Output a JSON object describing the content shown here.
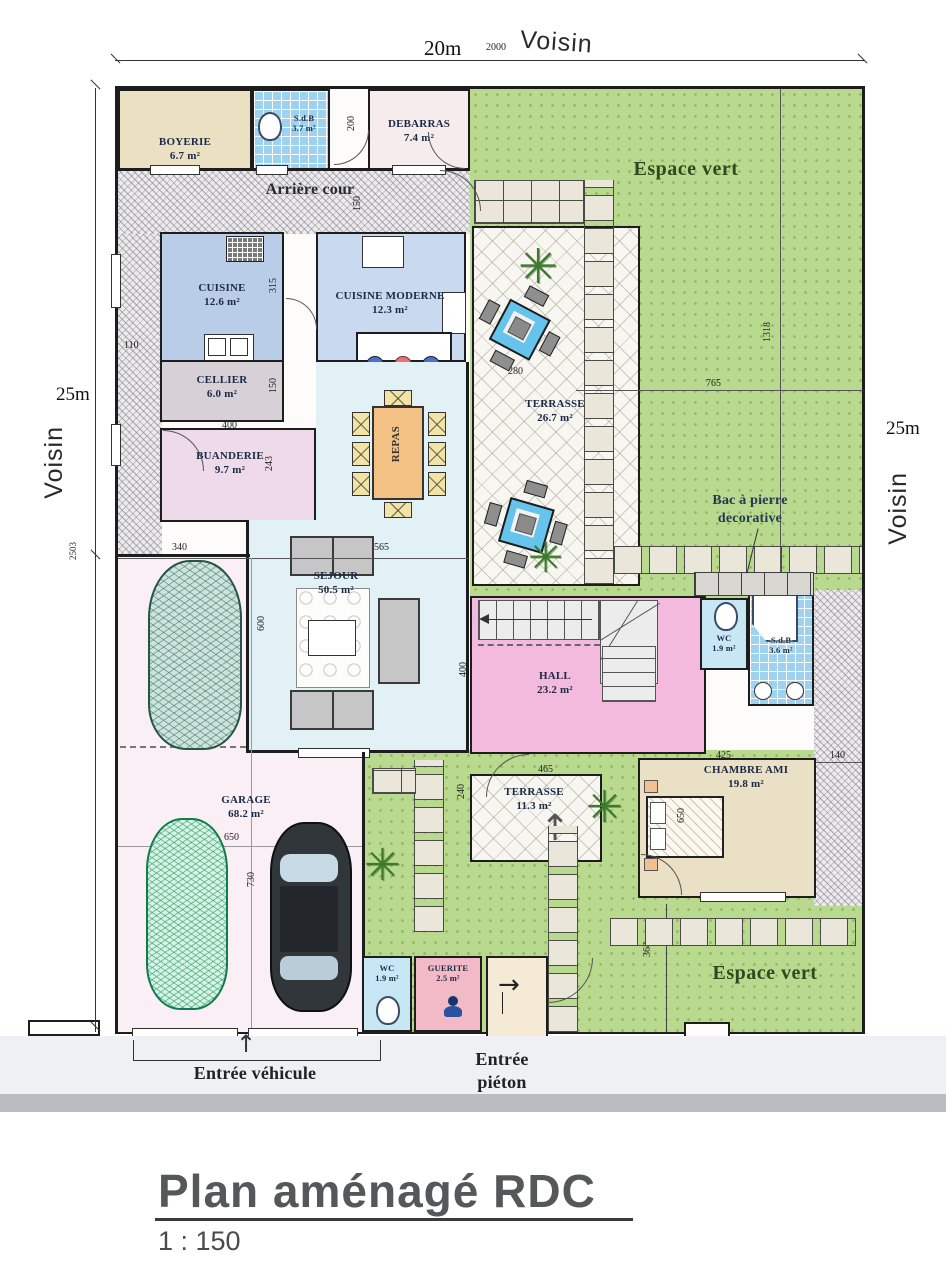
{
  "meta": {
    "title": "Plan aménagé RDC",
    "scale": "1 : 150"
  },
  "boundary": {
    "top_dim": "20m",
    "top_dim_small": "2000",
    "voisin_top": "Voisin",
    "left_dim": "25m",
    "voisin_left": "Voisin",
    "left_dim_small": "2503",
    "right_dim": "25m",
    "voisin_right": "Voisin"
  },
  "rooms": {
    "boyerie": {
      "name": "BOYERIE",
      "area": "6.7 m²"
    },
    "sdb_top": {
      "name": "S.d.B",
      "area": "3.7 m²"
    },
    "debarras": {
      "name": "DEBARRAS",
      "area": "7.4 m²"
    },
    "cuisine": {
      "name": "CUISINE",
      "area": "12.6 m²"
    },
    "cuisine_moderne": {
      "name": "CUISINE MODERNE",
      "area": "12.3 m²"
    },
    "cellier": {
      "name": "CELLIER",
      "area": "6.0 m²"
    },
    "buanderie": {
      "name": "BUANDERIE",
      "area": "9.7 m²"
    },
    "sejour": {
      "name": "SEJOUR",
      "area": "50.5 m²"
    },
    "terrasse_1": {
      "name": "TERRASSE",
      "area": "26.7 m²"
    },
    "hall": {
      "name": "HALL",
      "area": "23.2 m²"
    },
    "wc_top": {
      "name": "WC",
      "area": "1.9 m²"
    },
    "sdb_right": {
      "name": "S.d.B",
      "area": "3.6 m²"
    },
    "chambre_ami": {
      "name": "CHAMBRE AMI",
      "area": "19.8 m²"
    },
    "terrasse_2": {
      "name": "TERRASSE",
      "area": "11.3 m²"
    },
    "garage": {
      "name": "GARAGE",
      "area": "68.2 m²"
    },
    "wc_bottom": {
      "name": "WC",
      "area": "1.9 m²"
    },
    "guerite": {
      "name": "GUERITE",
      "area": "2.5 m²"
    }
  },
  "zones": {
    "arriere_cour": "Arrière cour",
    "espace_vert_top": "Espace vert",
    "espace_vert_bottom": "Espace vert",
    "repas": "REPAS",
    "bac_line1": "Bac à pierre",
    "bac_line2": "decorative",
    "entree_vehicule": "Entrée véhicule",
    "entree_pieton_1": "Entrée",
    "entree_pieton_2": "piéton"
  },
  "dims": {
    "d200": "200",
    "d150_top": "150",
    "d110": "110",
    "d315": "315",
    "d380": "380",
    "d400_cellier": "400",
    "d150_cellier": "150",
    "d243": "243",
    "d340": "340",
    "d565": "565",
    "d600": "600",
    "d280": "280",
    "d765": "765",
    "d1318": "1318",
    "d400_hall": "400",
    "d425": "425",
    "d140": "140",
    "d465": "465",
    "d240": "240",
    "d650_bed": "650",
    "d650_garage": "650",
    "d730": "730",
    "d368": "368"
  },
  "icons": {
    "plant": "✳",
    "arrow_up": "↑",
    "arrow_right": "→"
  },
  "colors": {
    "grass": "#b9d98e",
    "hall_pink": "#f3bade",
    "sejour_cyan": "#e2f1f5",
    "kitchen_blue": "#b9cce8",
    "tile_blue": "#9ed2ee",
    "guerite_pink": "#f2b9c6",
    "garage_pink": "#f9eff4",
    "beige": "#eae1c2",
    "wall": "#1d1d1d"
  }
}
